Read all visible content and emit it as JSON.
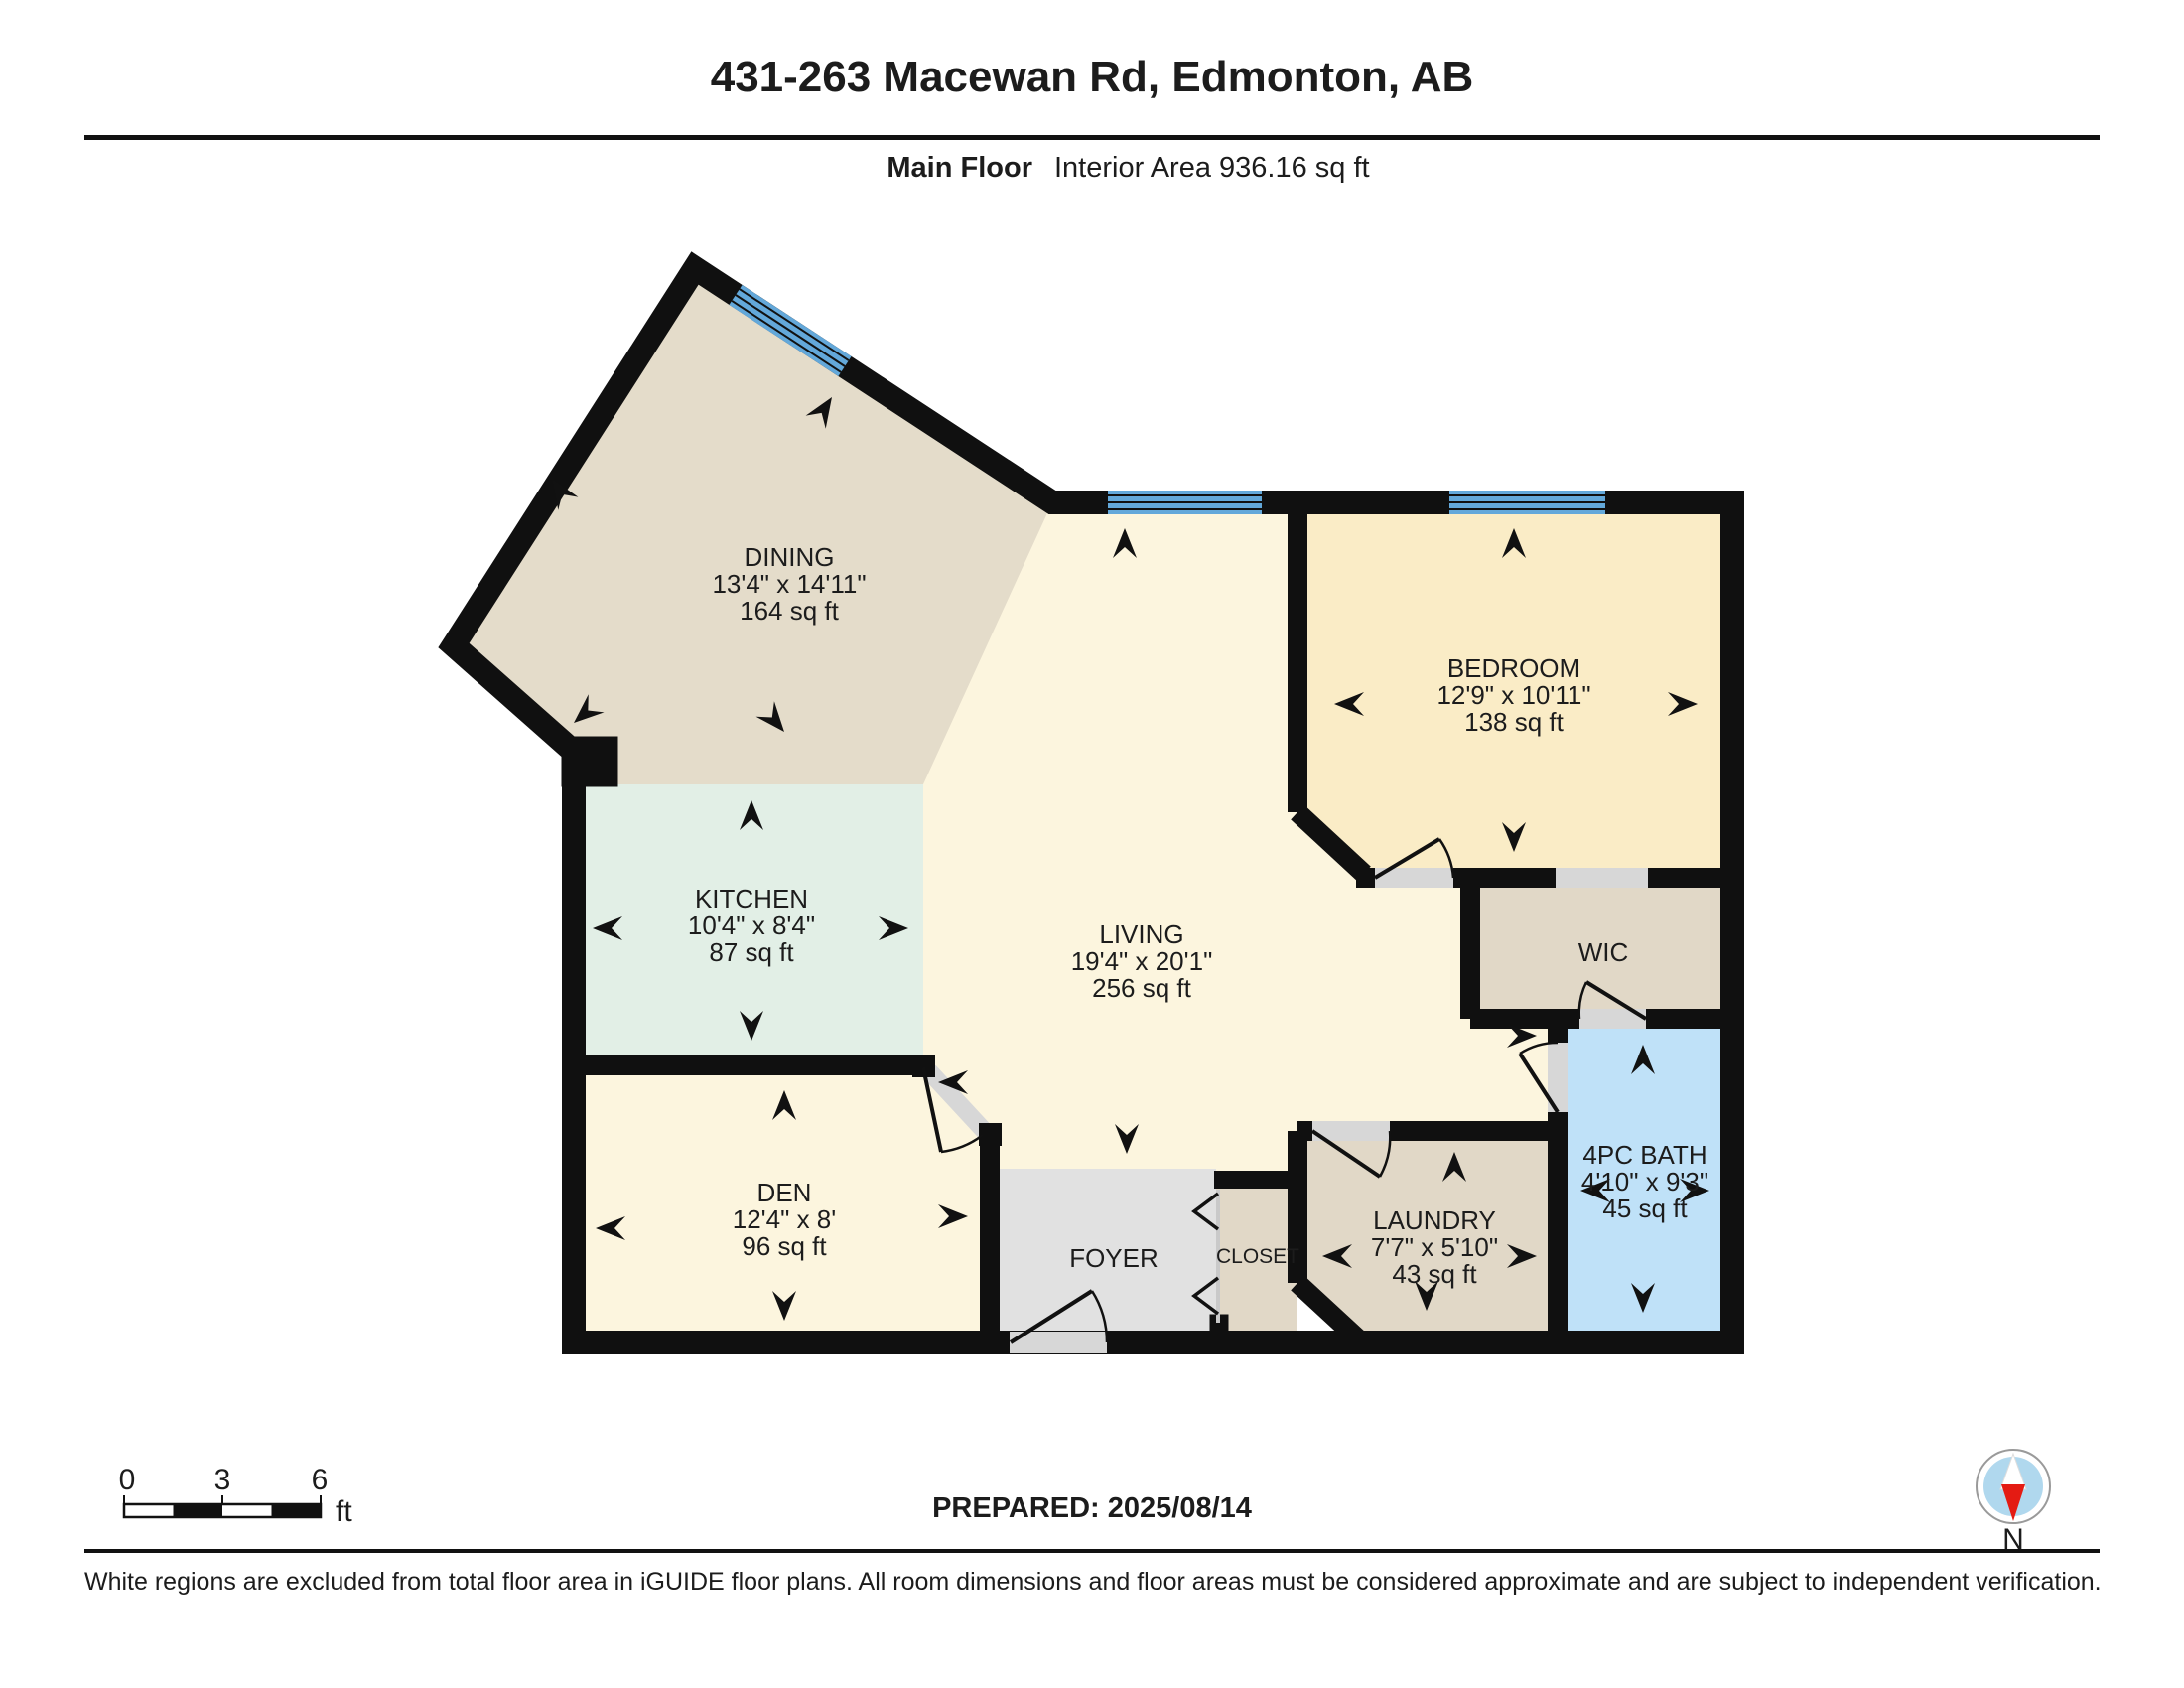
{
  "header": {
    "title": "431-263 Macewan Rd, Edmonton, AB",
    "floor_label": "Main Floor",
    "area_label": "Interior Area 936.16 sq ft"
  },
  "rooms": {
    "dining": {
      "name": "DINING",
      "dims": "13'4\" x 14'11\"",
      "area": "164 sq ft"
    },
    "living": {
      "name": "LIVING",
      "dims": "19'4\" x 20'1\"",
      "area": "256 sq ft"
    },
    "kitchen": {
      "name": "KITCHEN",
      "dims": "10'4\" x 8'4\"",
      "area": "87 sq ft"
    },
    "bedroom": {
      "name": "BEDROOM",
      "dims": "12'9\" x 10'11\"",
      "area": "138 sq ft"
    },
    "den": {
      "name": "DEN",
      "dims": "12'4\" x 8'",
      "area": "96 sq ft"
    },
    "laundry": {
      "name": "LAUNDRY",
      "dims": "7'7\" x 5'10\"",
      "area": "43 sq ft"
    },
    "bath": {
      "name": "4PC BATH",
      "dims": "4'10\" x 9'3\"",
      "area": "45 sq ft"
    },
    "wic": {
      "name": "WIC"
    },
    "foyer": {
      "name": "FOYER"
    },
    "closet": {
      "name": "CLOSET"
    }
  },
  "scale_bar": {
    "t0": "0",
    "t3": "3",
    "t6": "6",
    "unit": "ft"
  },
  "footer": {
    "prepared": "PREPARED: 2025/08/14",
    "compass_label": "N",
    "disclaimer": "White regions are excluded from total floor area in iGUIDE floor plans. All room dimensions and floor areas must be considered approximate and are subject to independent verification."
  },
  "colors": {
    "wall": "#101010",
    "dining": "#e4dcca",
    "living": "#fcf5de",
    "kitchen": "#e2efe6",
    "bedroom": "#faecc6",
    "tan": "#e1d8c7",
    "bath": "#bfe1f8",
    "foyer": "#e1e1e1",
    "threshold": "#d7d7d7",
    "window_blue": "#63a8da",
    "compass_blue": "#b0d8ee",
    "compass_red": "#e41b13"
  }
}
